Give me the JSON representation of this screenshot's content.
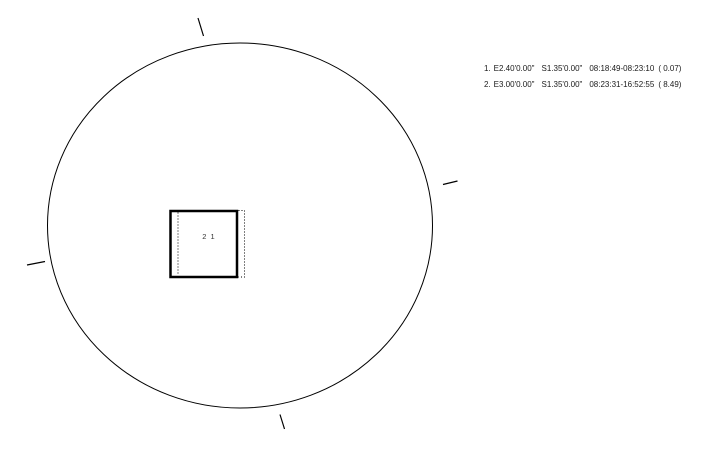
{
  "diagram": {
    "background": "#ffffff",
    "stroke_color": "#000000",
    "label_color": "#333333",
    "field_label": "2 1"
  },
  "annotations": {
    "entries": [
      {
        "num": "1.",
        "east": "E2.40'0.00\"",
        "south": "S1.35'0.00\"",
        "time_range": "08:18:49-08:23:10",
        "duration": "( 0.07)"
      },
      {
        "num": "2.",
        "east": "E3.00'0.00\"",
        "south": "S1.35'0.00\"",
        "time_range": "08:23:31-16:52:55",
        "duration": "( 8.49)"
      }
    ]
  }
}
